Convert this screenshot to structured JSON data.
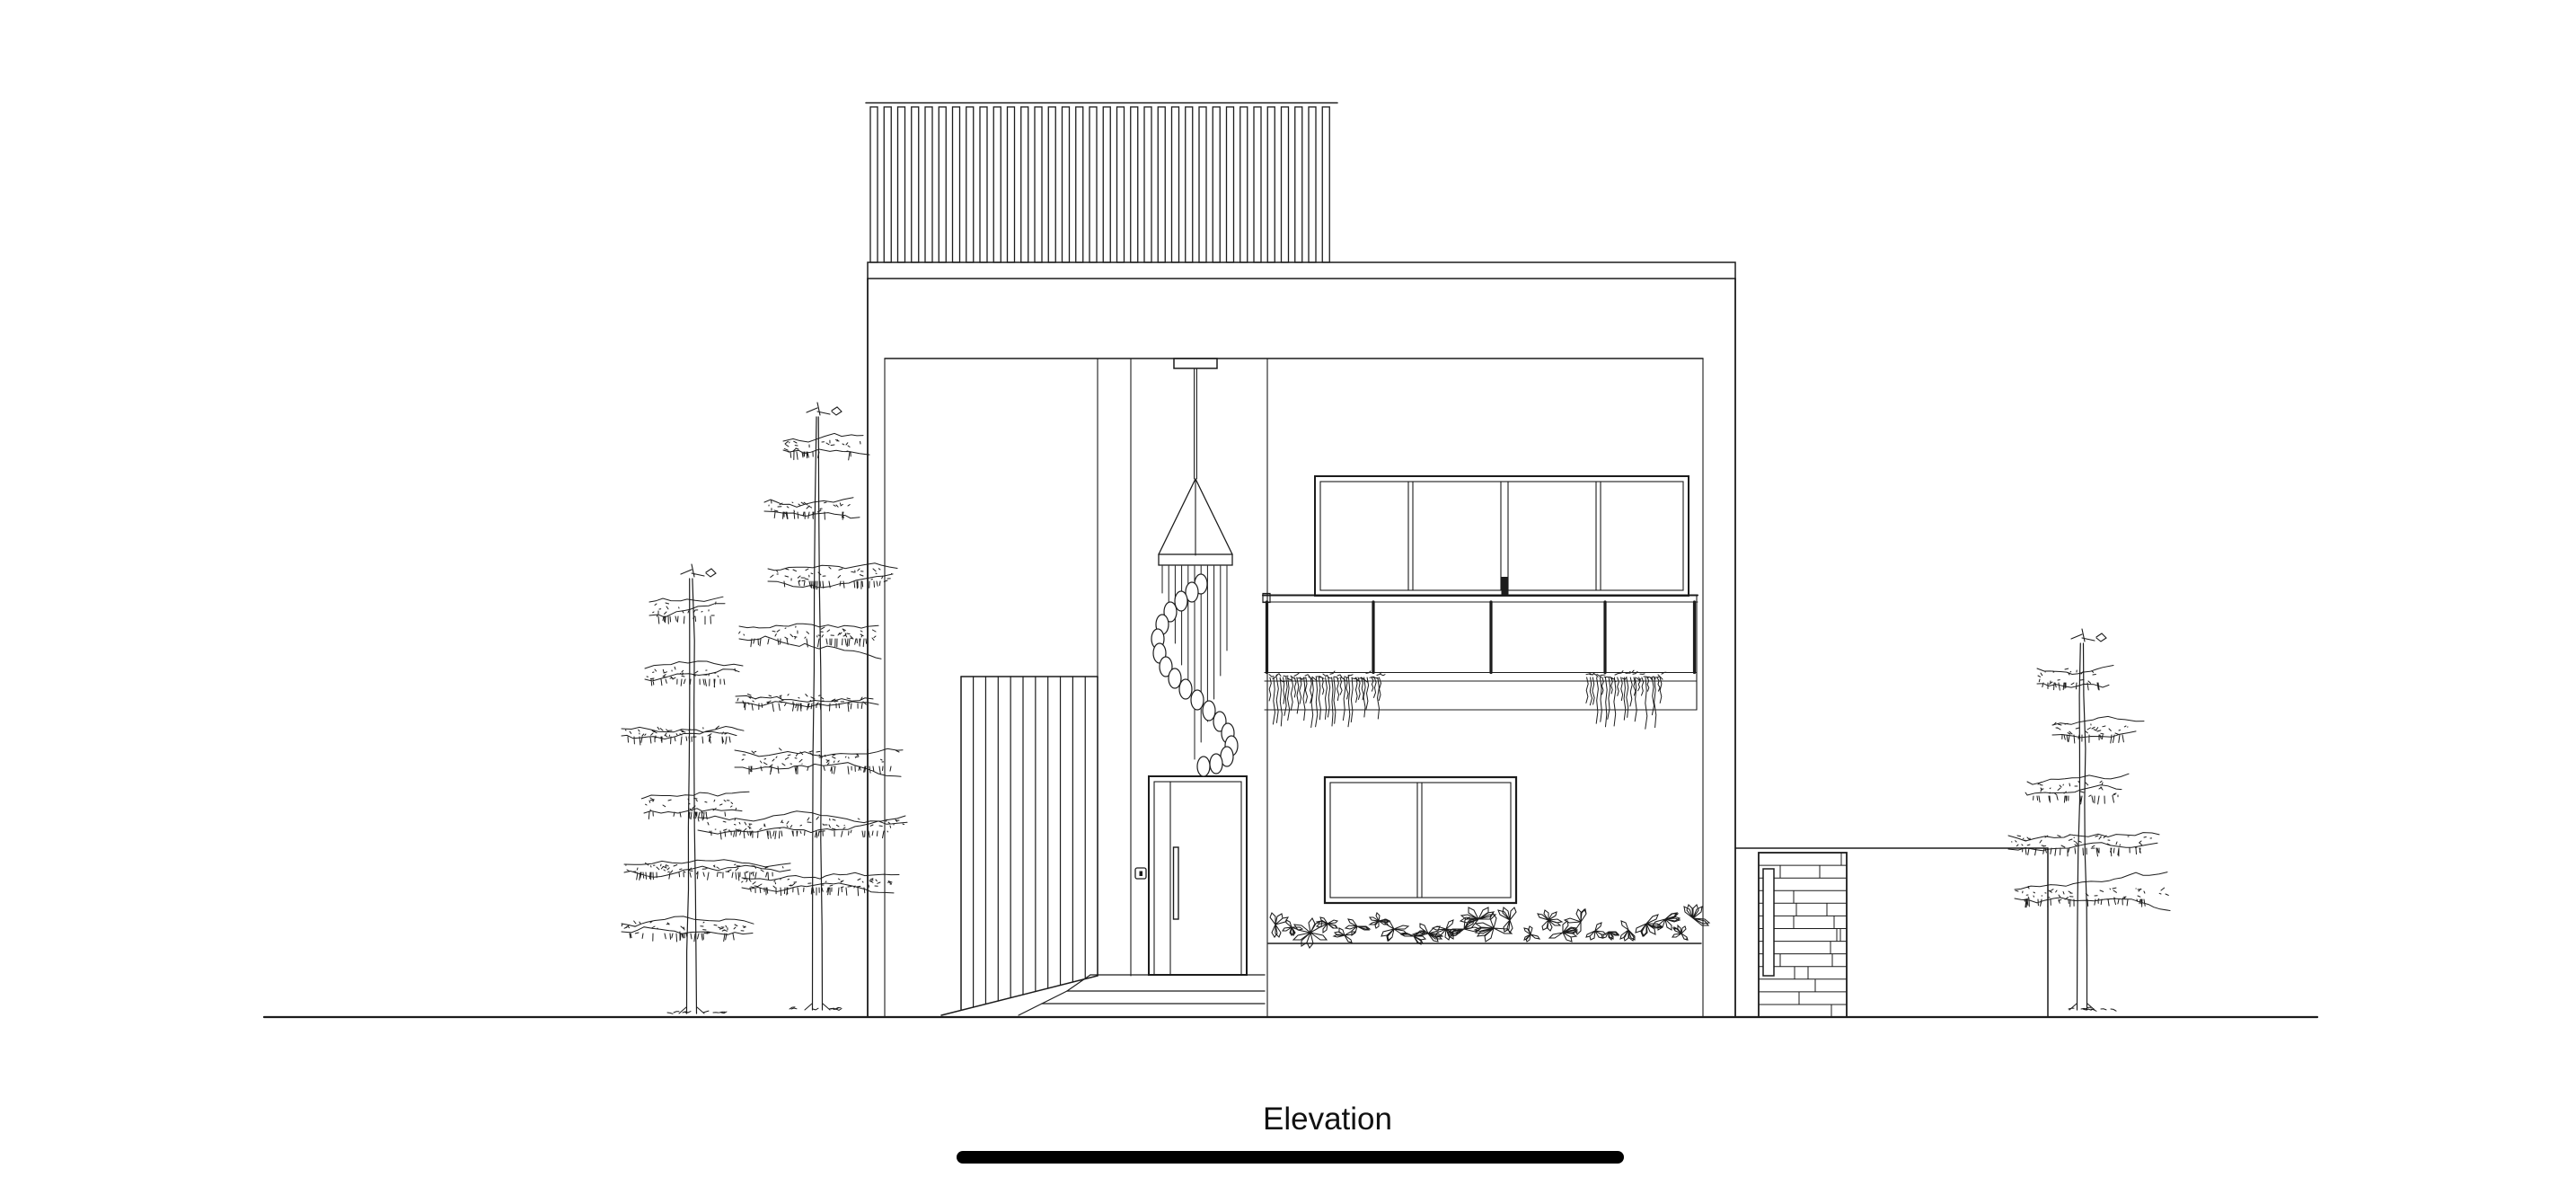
{
  "drawing": {
    "label": "Elevation"
  },
  "colors": {
    "background": "#ffffff",
    "ink": "#1c1c1c",
    "scale_bar": "#000000"
  },
  "counts": {
    "roof_louvers": 34,
    "screen_slats": 11,
    "upper_window_panes": 4,
    "balcony_panels": 4
  },
  "icons": {
    "pine_tree": "pine-tree-line-drawing",
    "pendant": "spiral-pendant-light-line-drawing"
  }
}
